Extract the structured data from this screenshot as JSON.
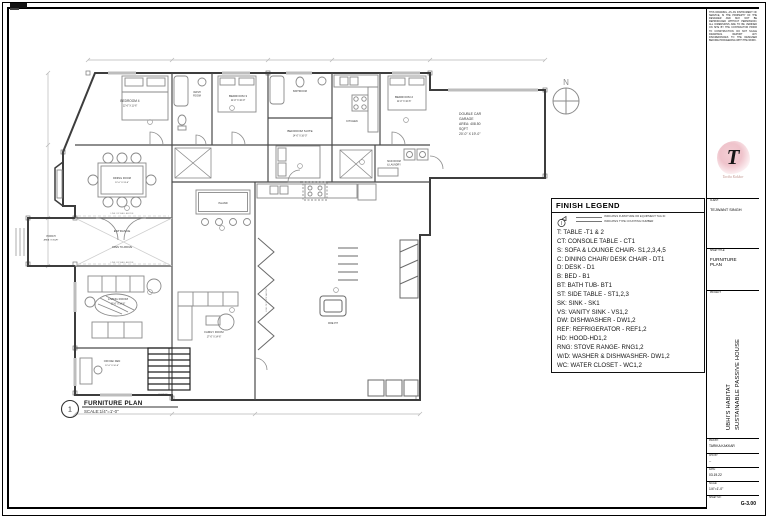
{
  "legend": {
    "title": "FINISH LEGEND",
    "note1": "INDICATES FURNITURE OR EQUIPMENT TAG ID",
    "note2": "INDICATES TYPE COUNTING NUMBER",
    "items": [
      "T: TABLE -T1 & 2",
      "CT: CONSOLE TABLE - CT1",
      "S: SOFA & LOUNGE CHAIR- S1,2,3,4,5",
      "C: DINING CHAIR/ DESK CHAIR - DT1",
      "D: DESK - D1",
      "B: BED - B1",
      "BT: BATH TUB- BT1",
      "ST: SIDE TABLE - ST1,2,3",
      "SK: SINK - SK1",
      "VS: VANITY SINK - VS1,2",
      "DW: DISHWASHER - DW1,2",
      "REF: REFRIGERATOR - REF1,2",
      "HD: HOOD-HD1,2",
      "RNG: STOVE RANGE- RNG1,2",
      "W/D: WASHER & DISHWASHER- DW1,2",
      "WC: WATER CLOSET - WC1,2"
    ]
  },
  "plan": {
    "labels": [
      "BEDROOM 4",
      "12'-6\" X 11'-6\"",
      "WASH",
      "ROOM",
      "BEDROOM 3",
      "11'-0\" X 10'-0\"",
      "BATHROOM",
      "BEDROOM SUITE",
      "14'-0\" X 16'-0\"",
      "KITCHEN",
      "BEDROOM 2",
      "11'-0\" X 10'-6\"",
      "MUD ROOM",
      "& LAUNDRY",
      "DINING ROOM",
      "12'-0\" X 13'-6\"",
      "LINE OF WALL ABOVE",
      "ENTRANCE",
      "OPEN TO ABOVE",
      "LINE OF WALL ABOVE",
      "PORCH",
      "AREA: 70 SQFT",
      "LIVING ROOM",
      "13'-6\" X 14'-6\"",
      "OFFICE/ DEN",
      "12'-6\" X 10'-6\"",
      "POWDER",
      "FAMILY ROOM",
      "17'-0\" X 14'-6\"",
      "ISLAND",
      "FIRE PIT",
      "LINE OF ROOF ABOVE",
      "N"
    ],
    "garage_note": [
      "DOUBLE CAR",
      "GARAGE",
      "AREA: 408.50",
      "SQFT",
      "20'-0\" X 19'-0\""
    ],
    "callout": {
      "number": "1",
      "title": "FURNITURE PLAN",
      "scale": "SCALE:1/4\"=1'-0\""
    }
  },
  "titleblock": {
    "disclaimer": "THIS DRAWING, AS AN INSTRUMENT OF SERVICE, IS THE PROPERTY OF THE DESIGNER AND MAY NOT BE REPRODUCED WITHOUT PERMISSION. ALL DIMENSIONS ARE TO BE VERIFIED ON SITE BY THE CONTRACTOR PRIOR TO CONSTRUCTION. DO NOT SCALE DRAWINGS. REPORT ANY DISCREPANCIES TO THE DESIGNER BEFORE PROCEEDING WITH THE WORK.",
    "logo": {
      "monogram": "T",
      "name": "Tarika Kakkar"
    },
    "client_label": "CLIENT:",
    "client": "TEJWANT SINGH",
    "sheet_title_label": "SHEET TITLE:",
    "sheet_title": "FURNITURE PLAN",
    "project_label": "PROJECT:",
    "project_line1": "UBHI'S HABITAT",
    "project_line2": "SUSTAINABLE PASSIVE HOUSE",
    "fields": [
      {
        "label": "DWN BY:",
        "value": "TARIKA KAKKAR"
      },
      {
        "label": "CHK BY:",
        "value": "--"
      },
      {
        "label": "DATE:",
        "value": "03.19.22"
      },
      {
        "label": "SCALE:",
        "value": "1/4\"=1'-0\""
      },
      {
        "label": "SHEET NO:",
        "value": "G-3.00"
      }
    ],
    "accent_pink": "#efc3cb",
    "line_black": "#000000",
    "wall_gray": "#3d3d3d"
  }
}
